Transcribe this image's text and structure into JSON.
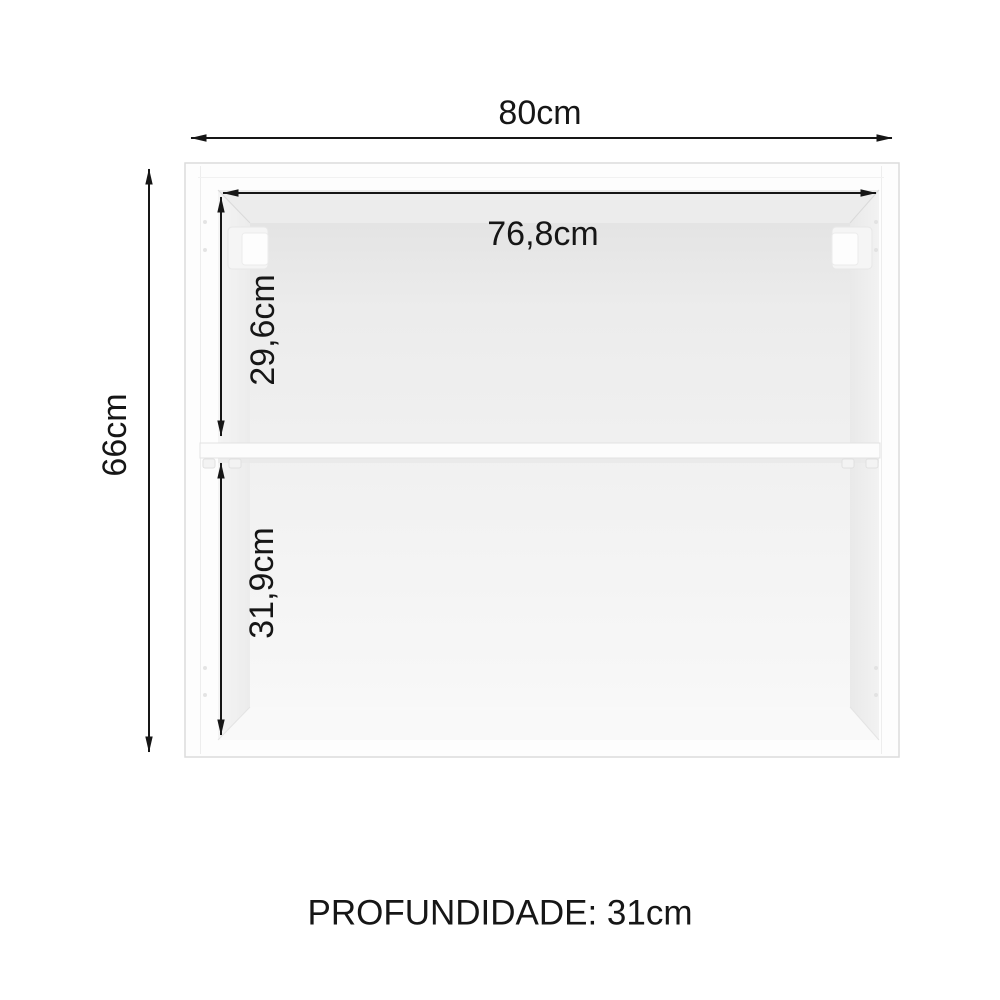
{
  "diagram": {
    "caption": "PROFUNDIDADE: 31cm",
    "dim_outer_width": "80cm",
    "dim_outer_height": "66cm",
    "dim_inner_width": "76,8cm",
    "dim_upper_height": "29,6cm",
    "dim_lower_height": "31,9cm",
    "colors": {
      "line": "#161616",
      "background": "#ffffff",
      "cabinet_face": "#fdfdfd",
      "cabinet_border": "#dcdcdc",
      "interior_shadow": "#e6e6e6",
      "interior_light": "#f8f8f8",
      "shelf_face": "#fcfcfc"
    }
  }
}
